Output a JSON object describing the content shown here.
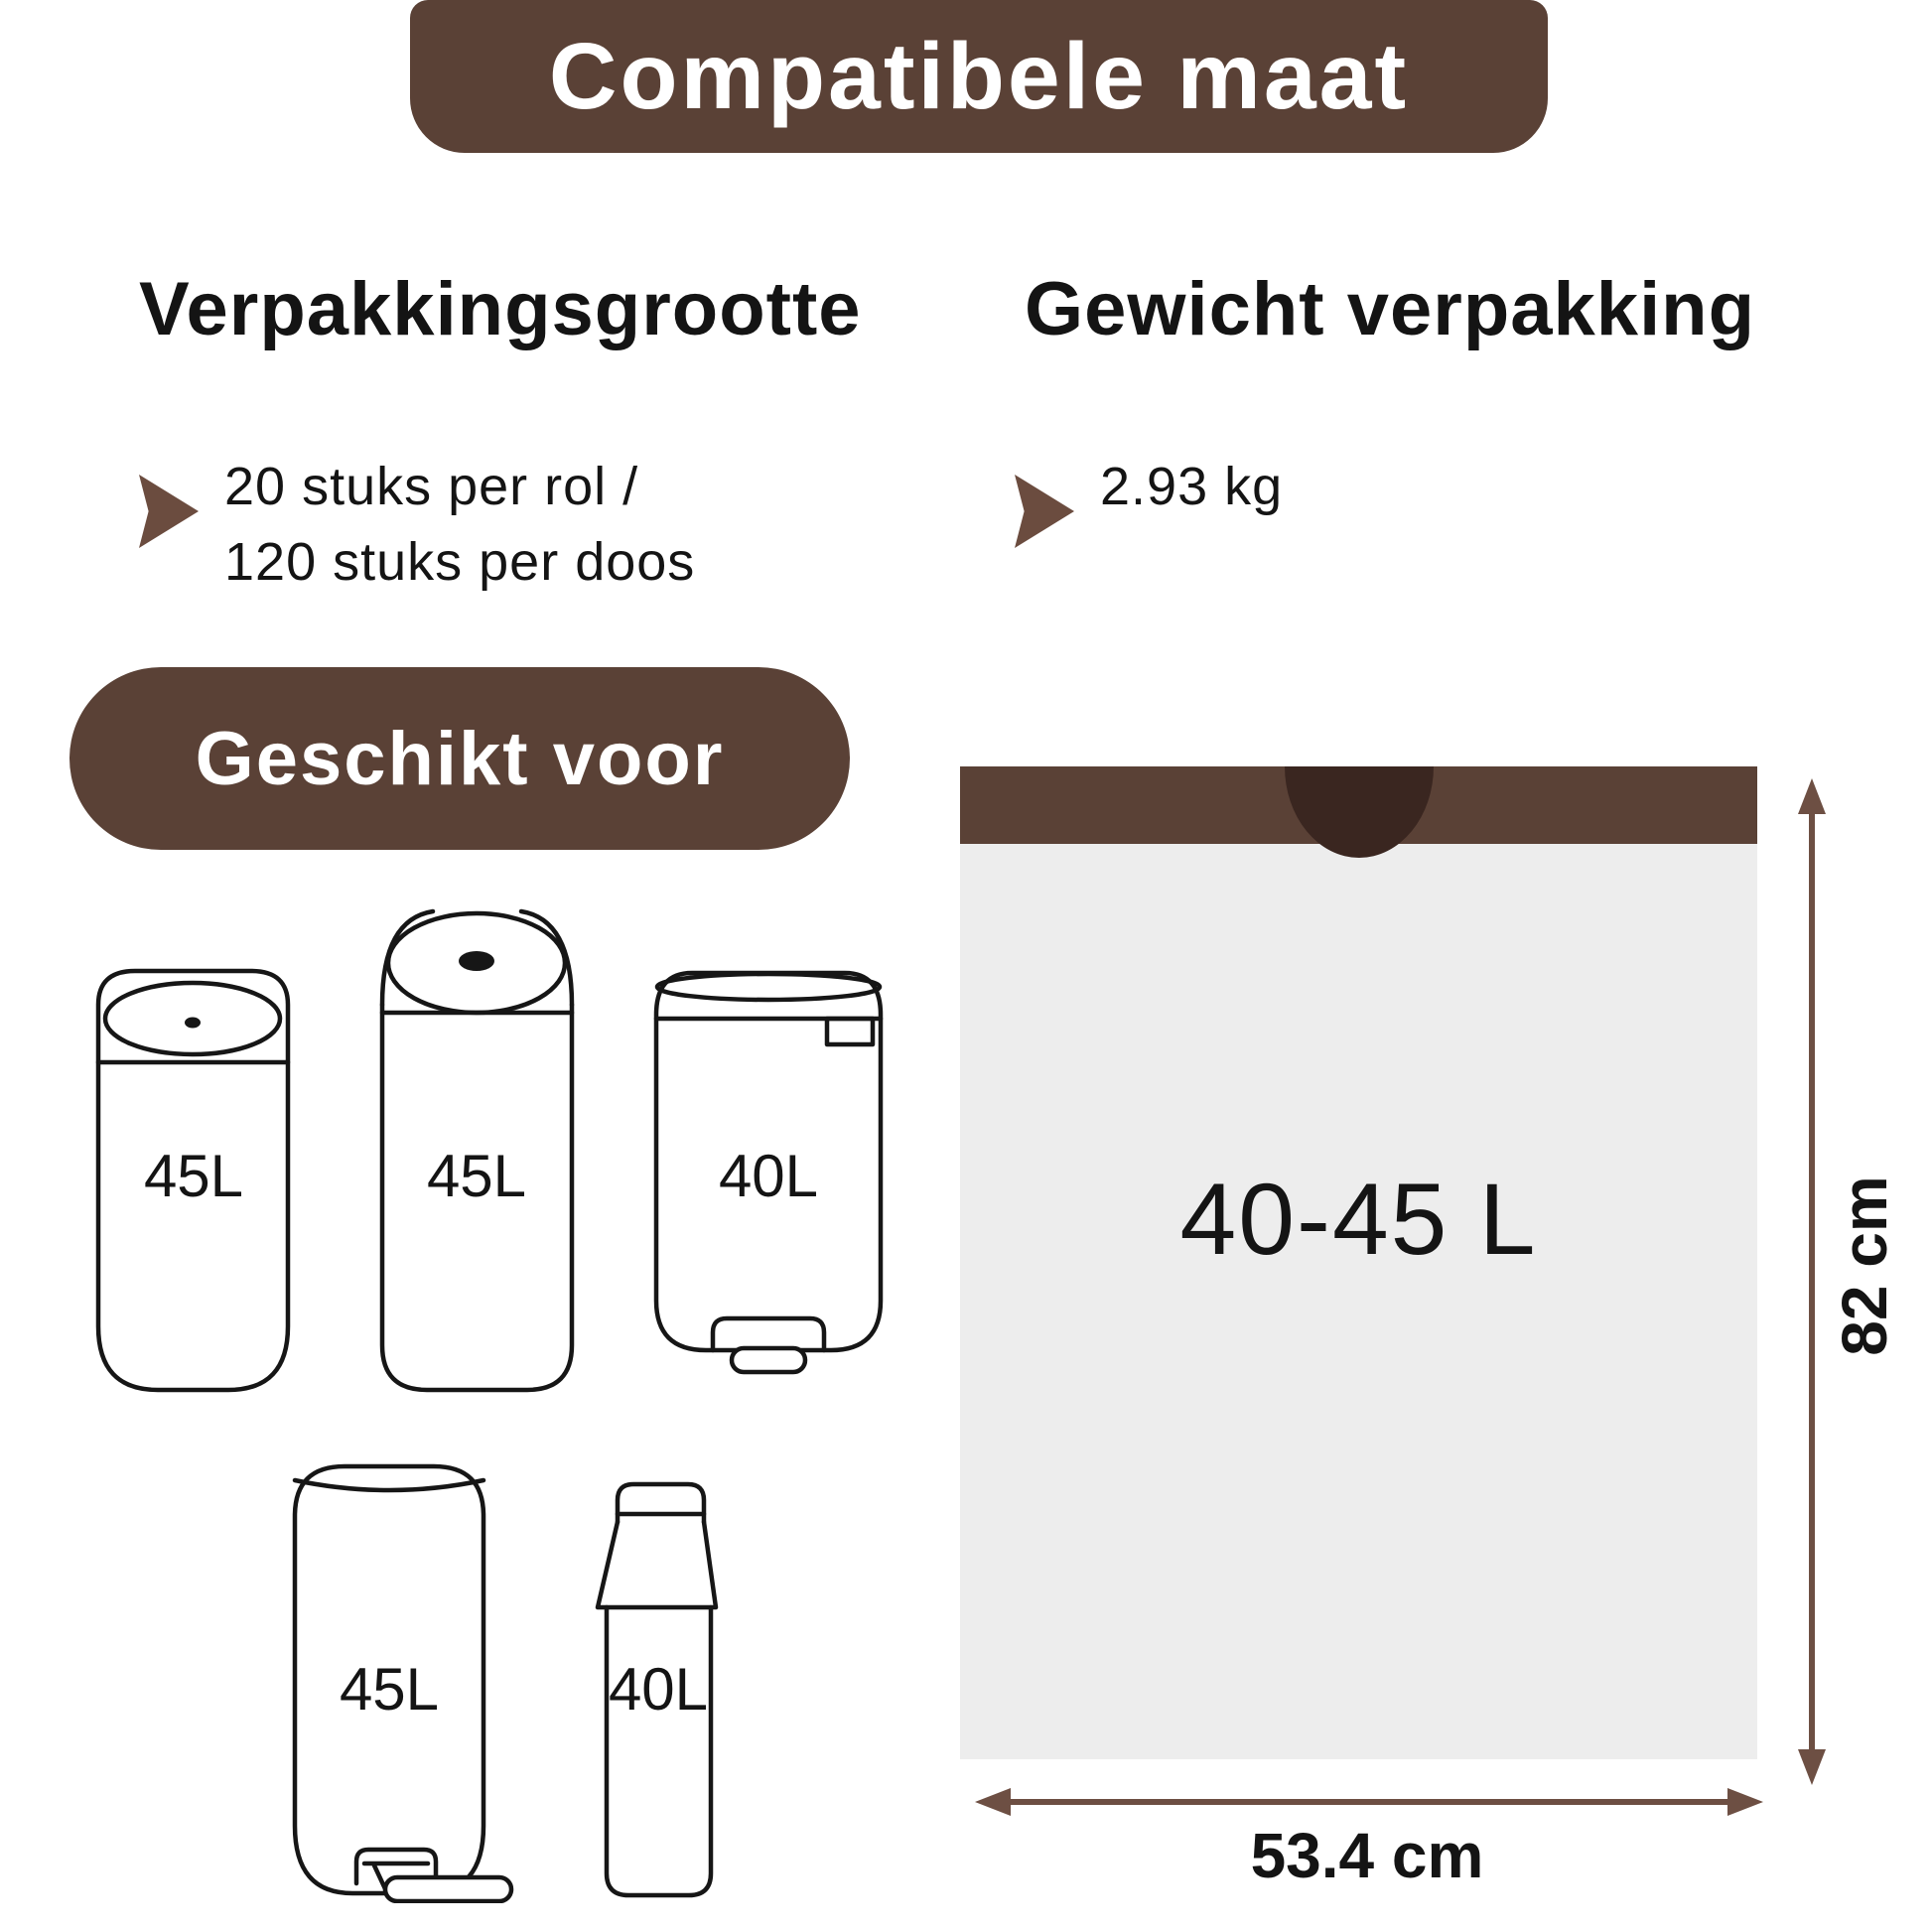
{
  "banner": {
    "title": "Compatibele maat"
  },
  "package_size": {
    "heading": "Verpakkingsgrootte",
    "line1": "20 stuks per rol /",
    "line2": "120 stuks per doos"
  },
  "package_weight": {
    "heading": "Gewicht verpakking",
    "value": "2.93 kg"
  },
  "suitable_for": {
    "label": "Geschikt voor",
    "bins": [
      {
        "capacity": "45L",
        "type": "touch bin"
      },
      {
        "capacity": "45L",
        "type": "open-top bin"
      },
      {
        "capacity": "40L",
        "type": "pedal bin"
      },
      {
        "capacity": "45L",
        "type": "pedal bin"
      },
      {
        "capacity": "40L",
        "type": "slim handle bin"
      }
    ]
  },
  "bag": {
    "capacity": "40-45 L",
    "height": "82 cm",
    "width": "53.4 cm"
  },
  "colors": {
    "brown": "#5a4136",
    "dark_brown": "#3a2620",
    "arrow_brown": "#6d4f43",
    "bullet_brown": "#6b4c3f",
    "bag_grey": "#ededed",
    "outline_black": "#161616",
    "text": "#141414",
    "white": "#ffffff"
  }
}
